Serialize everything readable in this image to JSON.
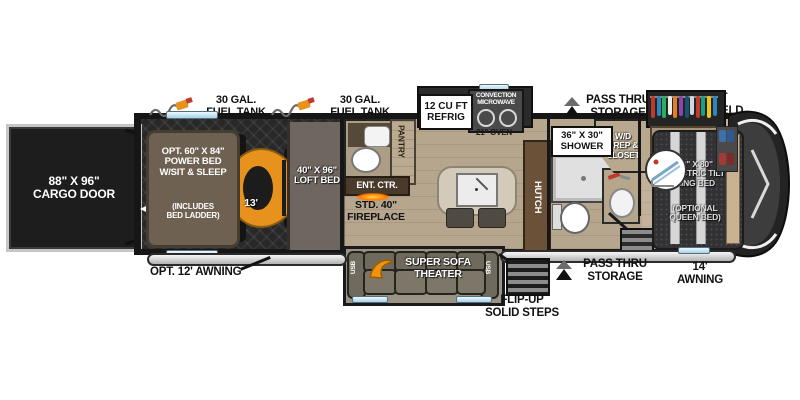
{
  "exterior": {
    "cargo_door": "88\" X 96\"\nCARGO DOOR",
    "fuel_tank_rear": "30 GAL.\nFUEL TANK",
    "fuel_tank_mid": "30 GAL.\nFUEL TANK",
    "awning_rear": "OPT. 12' AWNING",
    "awning_front": "14'\nAWNING",
    "front_windshield": "FRONT\nWINDSHIELD",
    "pass_thru_top": "PASS THRU\nSTORAGE",
    "pass_thru_bottom": "PASS THRU\nSTORAGE",
    "flip_up_steps": "FLIP-UP\nSOLID STEPS"
  },
  "garage": {
    "power_bed": "OPT. 60\" X 84\"\nPOWER BED\nW/SIT & SLEEP",
    "power_bed_note": "(INCLUDES\nBED LADDER)",
    "length": "13'",
    "loft_bed": "40\" X 96\"\nLOFT BED"
  },
  "kitchen": {
    "refrigerator": "12 CU FT\nREFRIG",
    "microwave": "CONVECTION\nMICROWAVE",
    "oven": "21\" OVEN",
    "pantry": "PANTRY",
    "hutch": "HUTCH",
    "ent_ctr": "ENT. CTR.",
    "fireplace": "STD. 40\"\nFIREPLACE"
  },
  "living": {
    "sofa": "SUPER SOFA\nTHEATER",
    "usb_left": "USB",
    "usb_right": "USB"
  },
  "bathroom": {
    "shower": "36\" X 30\"\nSHOWER",
    "wd_closet": "W/D\nPREP &\nCLOSET"
  },
  "bedroom": {
    "bed": "70\" X 80\"\nELECTRIC TILT\nKING BED",
    "bed_option": "(OPTIONAL\nQUEEN BED)"
  },
  "colors": {
    "accent_orange": "#e8921e",
    "floor_wood": "#b7a68e",
    "garage_floor": "#282828",
    "wall": "#161616",
    "slide_topper_blue": "#cfe9f6"
  }
}
